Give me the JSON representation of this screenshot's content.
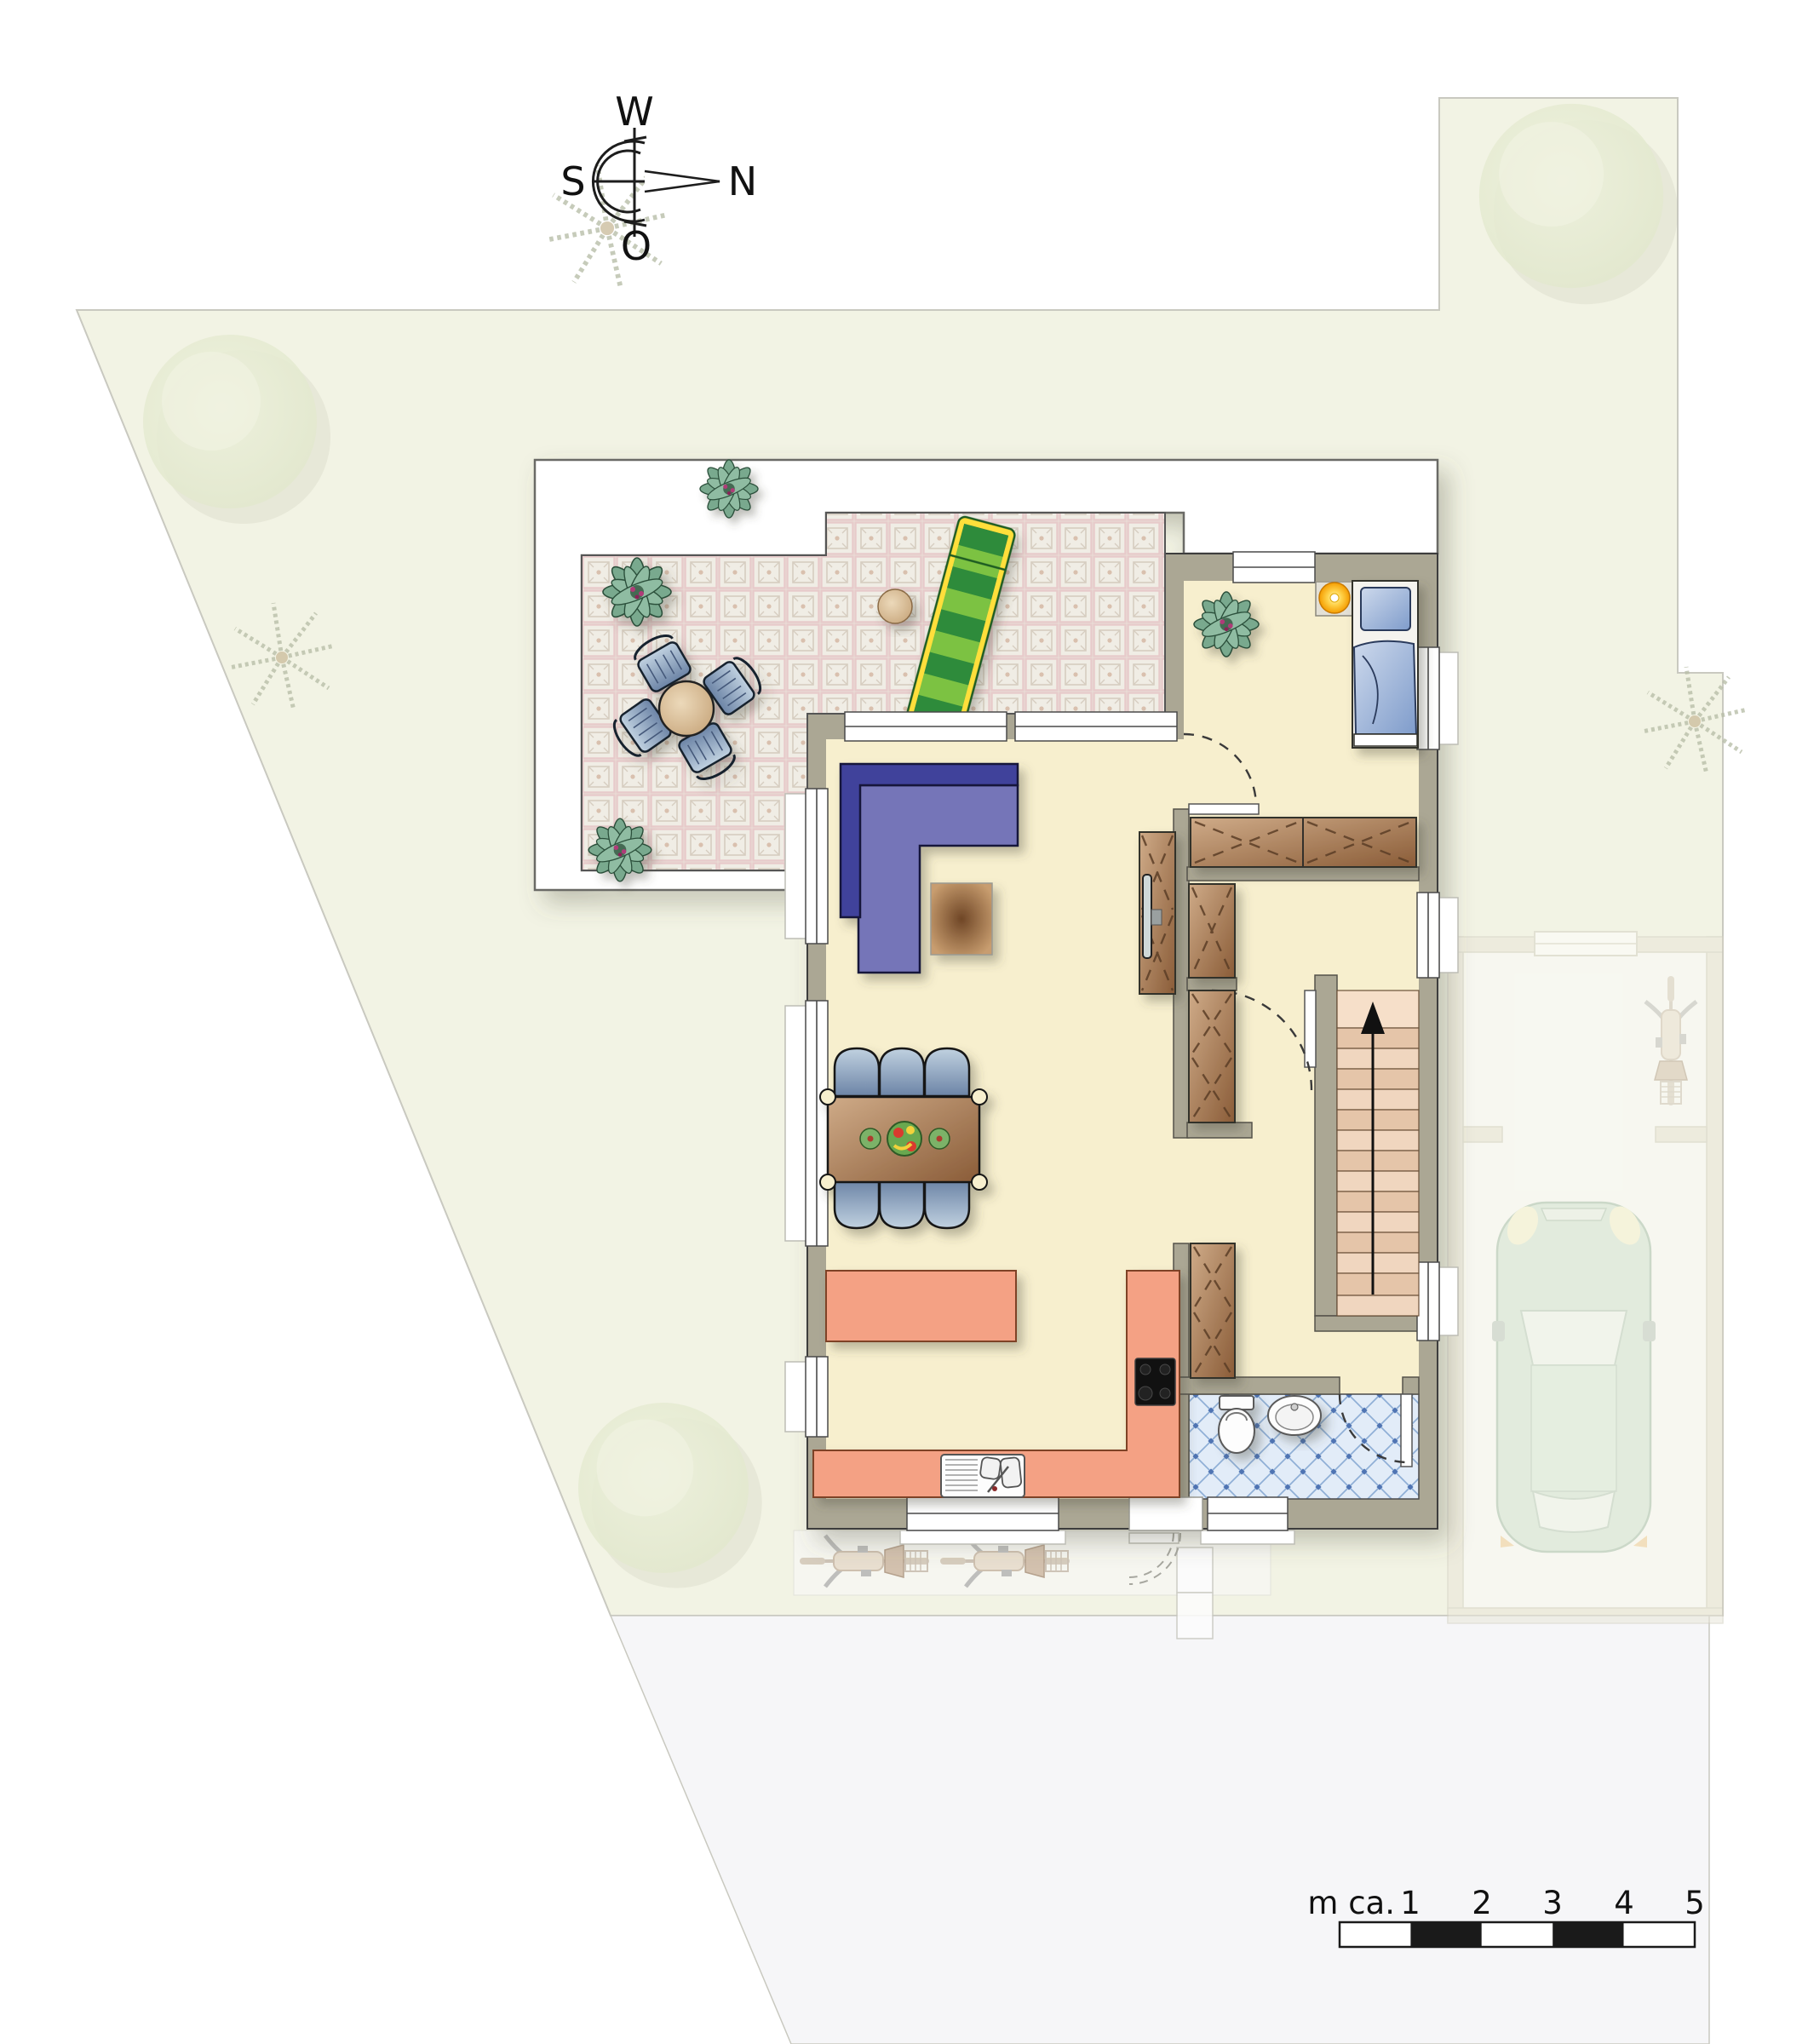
{
  "compass": {
    "west": "W",
    "north": "N",
    "south": "S",
    "east": "O"
  },
  "scale_bar": {
    "unit_label": "m ca.",
    "labels": [
      "1",
      "2",
      "3",
      "4",
      "5"
    ],
    "segments": 5,
    "meters_total": 5
  },
  "palette": {
    "parcel": "#f2f3e4",
    "parcel-border": "#c9c9c0",
    "road": "#f6f6f8",
    "white": "#ffffff",
    "outline": "#3c3c3c",
    "wall": "#aba794",
    "floor": "#f7efce",
    "tile-base": "#ebe8df",
    "tile-line": "#d6cdc0",
    "grout": "#e7caca",
    "sofa-dark": "#41439b",
    "sofa-light": "#7475b8",
    "salmon": "#f4a184",
    "wood-dark": "#8a5c38",
    "wood-light": "#cfab88",
    "bath-tile-bg": "#e2ecf8",
    "bath-tile-line": "#8fafd6",
    "bath-tile-dot": "#4f74b3",
    "chair-dark": "#6c84a6",
    "chair-light": "#c0d1e0",
    "stair-light": "#f0d6bf",
    "stair-dark": "#e5c5a9",
    "stair-first": "#f6dfc9",
    "bed-dark": "#7f9ccb",
    "bed-light": "#cdd9ec",
    "lamp-orange": "#f59d00",
    "plant-green": "#79a98e",
    "plant-dark": "#2c4f3a",
    "ghost-stroke": "#b9bfa9",
    "tree-fill": "#e2e8cd",
    "car-body": "#cfe2d4",
    "lounger-green": "#2e8b3a",
    "lounger-light": "#7cc242",
    "lounger-yellow": "#ffdf3a",
    "tan": "#c9a87e"
  },
  "icons": [
    "compass-rose-icon",
    "scale-bar",
    "tree-icon",
    "palm-icon",
    "plant-icon",
    "sun-lounger-icon",
    "patio-table-icon",
    "patio-chair-icon",
    "sofa-icon",
    "coffee-table-icon",
    "tv-icon",
    "sideboard-icon",
    "dining-table-icon",
    "dining-chair-icon",
    "fruit-bowl-icon",
    "kitchen-counter-icon",
    "cooktop-icon",
    "kitchen-sink-icon",
    "wardrobe-icon",
    "stairs-icon",
    "stairs-up-arrow-icon",
    "toilet-icon",
    "wash-basin-icon",
    "bed-icon",
    "bedside-lamp-icon",
    "door-swing-icon",
    "entrance-steps-icon",
    "bicycle-icon",
    "car-icon",
    "garage"
  ]
}
